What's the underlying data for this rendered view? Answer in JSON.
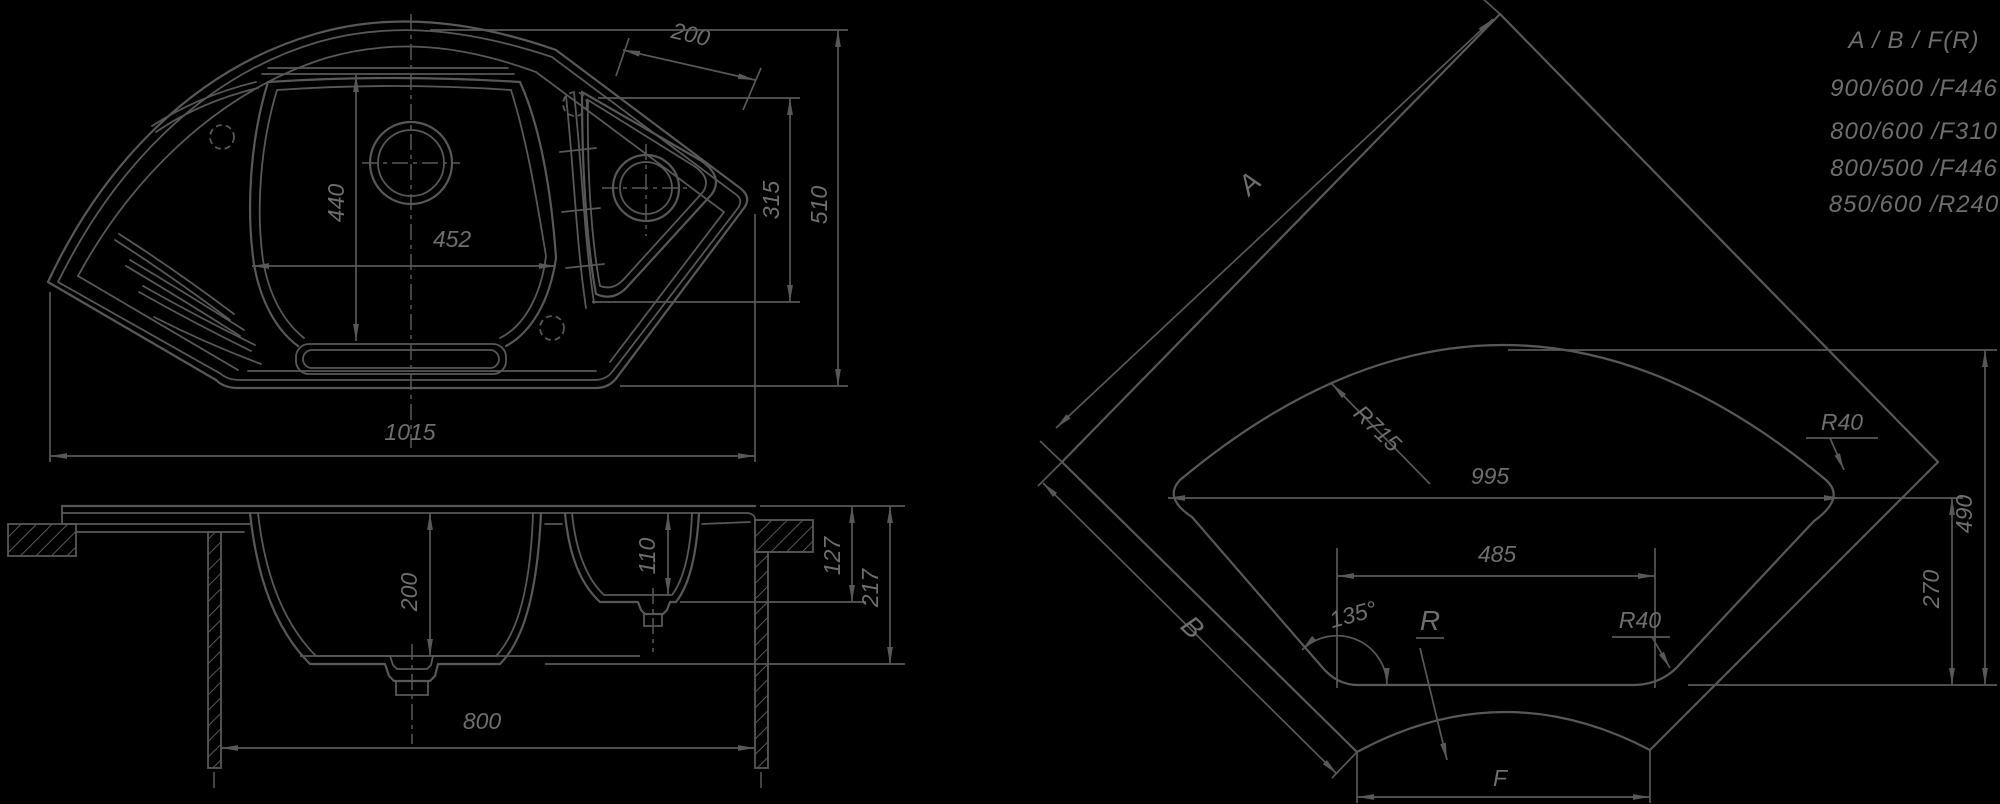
{
  "colors": {
    "background": "#000000",
    "line": "#585858",
    "text": "#6e6e6e"
  },
  "views": {
    "plan": {
      "title": "sink top view",
      "dims": {
        "drainer_width": "200",
        "bowl_length": "440",
        "bowl_width": "452",
        "side_inner": "315",
        "side_overall": "510",
        "overall_width": "1015"
      }
    },
    "section": {
      "title": "sink section view",
      "dims": {
        "bowl_depth": "200",
        "small_bowl_depth": "110",
        "edge_height": "127",
        "overall_height": "217",
        "cabinet_width": "800"
      }
    },
    "corner": {
      "title": "corner installation view",
      "labels": {
        "side_a": "A",
        "side_b": "B",
        "front_width": "F",
        "front_radius": "R"
      },
      "dims": {
        "back_arc_radius": "R715",
        "opening_width": "995",
        "tip_radius": "R40",
        "front_flat_width": "485",
        "corner_angle": "135°",
        "front_fillet_radius": "R40",
        "opening_depth": "490",
        "front_inner_depth": "270"
      }
    }
  },
  "size_table": {
    "header": "A / B / F(R)",
    "rows": [
      "900/600 /F446",
      "800/600 /F310",
      "800/500 /F446",
      "850/600 /R240"
    ]
  }
}
